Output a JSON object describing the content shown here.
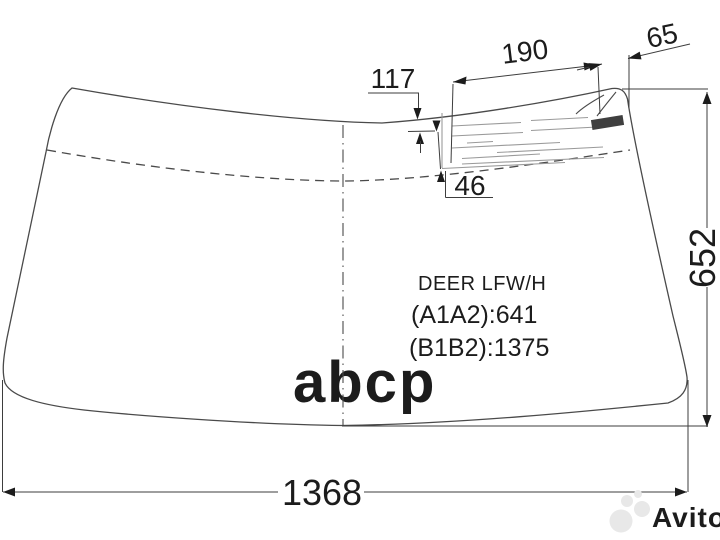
{
  "diagram": {
    "part_text": {
      "line1": "DEER LFW/H",
      "line2": "(A1A2):641",
      "line3": "(B1B2):1375"
    },
    "dimensions": {
      "label_top_offset": "117",
      "label_width": "190",
      "label_edge_gap": "65",
      "label_bottom_offset": "46",
      "glass_height": "652",
      "glass_width": "1368"
    },
    "colors": {
      "outline": "#4a4a4a",
      "dimension": "#3d3d3d",
      "text": "#1c1c1c",
      "label_lines": "#9a9a9a",
      "label_mark": "#3f3f3f",
      "watermark_abcp": "#b6b6b6",
      "watermark_avito": "#e8e8e8"
    }
  },
  "watermarks": {
    "abcp": "abcp",
    "avito": "Avito"
  }
}
